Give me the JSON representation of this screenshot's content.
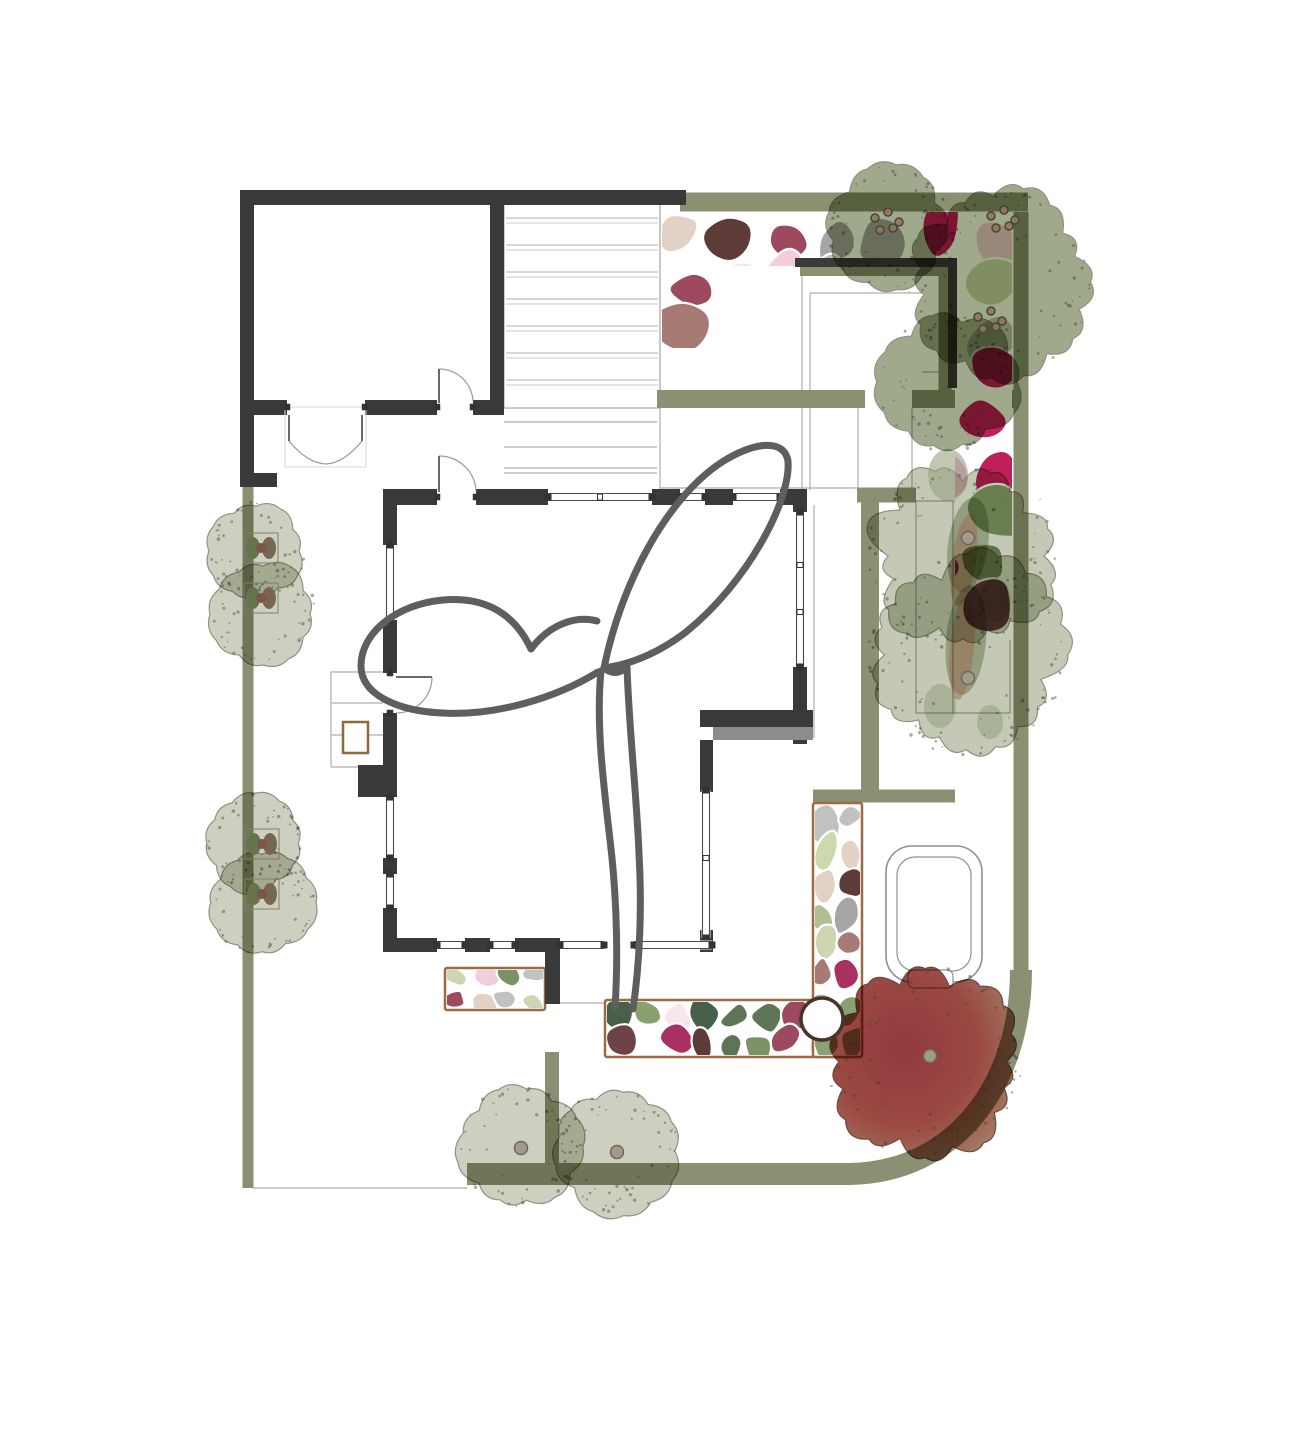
{
  "palette": {
    "wall": "#3a3a3a",
    "wall_shadow": "#8c8c8c",
    "hedge": "#8a9072",
    "line": "#adadad",
    "line_light": "#c9c9c9",
    "canopy_outline": "#5e5e5e",
    "bed_border": "#9c6b44",
    "tree_pale": "#c8cbb9",
    "tree_olive": "#97a081",
    "tree_mid": "#bdc3ad",
    "tree_stroke": "#8f9383",
    "speckle": "#3e4434",
    "berry_fill": "#8a7a57",
    "berry_stroke": "#4a4433",
    "shrub_green": "#66744b",
    "shrub_brown": "#77674e",
    "shrub_dot": "#7b544a",
    "ring_stroke": "#46332a",
    "tub_stroke": "#909090",
    "bench_stroke": "#8a6b3f",
    "red_tree_stops": [
      "#8c3136",
      "#97423c",
      "#9c6e57",
      "#a2a48a"
    ],
    "pebbles": [
      "#e9a3c0",
      "#f2cedd",
      "#f7e7ea",
      "#e2d2c6",
      "#bf2059",
      "#a93061",
      "#9d4a5e",
      "#a87a74",
      "#8a5f58",
      "#6e4347",
      "#5d3b39",
      "#8ba06f",
      "#5f7454",
      "#47604b",
      "#aebf92",
      "#ccd8ae",
      "#7d9166",
      "#a6a6a6",
      "#bfc2be",
      "#cdd6b0"
    ]
  },
  "plan": {
    "canvas": {
      "w": 1291,
      "h": 1429
    },
    "paving": {
      "deck_rect": [
        504,
        197,
        156,
        211
      ],
      "plank_ys": [
        218,
        245,
        272,
        299,
        326,
        353,
        380
      ],
      "plank_x": [
        506,
        658
      ],
      "lines": [
        [
          504,
          422,
          657,
          422
        ],
        [
          504,
          447,
          657,
          447
        ],
        [
          504,
          468,
          657,
          468
        ],
        [
          504,
          473,
          657,
          473
        ],
        [
          660,
          197,
          660,
          490
        ],
        [
          802,
          266,
          802,
          490
        ],
        [
          810,
          293,
          810,
          490
        ],
        [
          858,
          408,
          858,
          488
        ],
        [
          912,
          408,
          912,
          488
        ],
        [
          832,
          268,
          945,
          268
        ],
        [
          810,
          293,
          922,
          293
        ],
        [
          922,
          372,
          945,
          372
        ],
        [
          660,
          488,
          858,
          488
        ],
        [
          814,
          505,
          814,
          738
        ],
        [
          331,
          672,
          331,
          767
        ],
        [
          331,
          672,
          383,
          672
        ],
        [
          331,
          703,
          383,
          703
        ],
        [
          331,
          735,
          383,
          735
        ],
        [
          331,
          767,
          383,
          767
        ],
        [
          253,
          1188,
          467,
          1188
        ],
        [
          540,
          1003,
          605,
          1003
        ]
      ],
      "structure_rect": [
        916,
        501,
        94,
        212
      ],
      "structure_line": [
        953,
        501,
        953,
        713
      ]
    },
    "hedges": [
      {
        "x1": 680,
        "y1": 202,
        "x2": 1028,
        "y2": 202,
        "w": 19
      },
      {
        "x1": 1021,
        "y1": 212,
        "x2": 1021,
        "y2": 975,
        "w": 15
      },
      {
        "d": "M 1021,970 C 1021,1085 955,1172 850,1174 L 467,1174",
        "w": 22
      },
      {
        "x1": 248,
        "y1": 487,
        "x2": 248,
        "y2": 1188,
        "w": 11
      },
      {
        "x1": 657,
        "y1": 399,
        "x2": 865,
        "y2": 399,
        "w": 18
      },
      {
        "x1": 912,
        "y1": 399,
        "x2": 1021,
        "y2": 399,
        "w": 18
      },
      {
        "x1": 857,
        "y1": 495,
        "x2": 916,
        "y2": 495,
        "w": 15
      },
      {
        "x1": 552,
        "y1": 1052,
        "x2": 552,
        "y2": 1174,
        "w": 14
      },
      {
        "x1": 813,
        "y1": 796,
        "x2": 955,
        "y2": 796,
        "w": 13
      },
      {
        "x1": 870,
        "y1": 500,
        "x2": 870,
        "y2": 798,
        "w": 18
      },
      {
        "x1": 800,
        "y1": 271,
        "x2": 950,
        "y2": 271,
        "w": 10
      },
      {
        "x1": 945,
        "y1": 266,
        "x2": 945,
        "y2": 392,
        "w": 13
      }
    ],
    "walls": [
      [
        240,
        190,
        446,
        15
      ],
      [
        240,
        190,
        14,
        297
      ],
      [
        490,
        190,
        14,
        225
      ],
      [
        254,
        400,
        33,
        15
      ],
      [
        365,
        400,
        72,
        15
      ],
      [
        473,
        400,
        31,
        15
      ],
      [
        243,
        473,
        34,
        14
      ],
      [
        795,
        258,
        162,
        9
      ],
      [
        948,
        258,
        9,
        130
      ],
      [
        388,
        489,
        49,
        16
      ],
      [
        476,
        489,
        72,
        16
      ],
      [
        652,
        489,
        28,
        16
      ],
      [
        705,
        489,
        28,
        16
      ],
      [
        780,
        489,
        27,
        16
      ],
      [
        793,
        489,
        14,
        23
      ],
      [
        793,
        667,
        14,
        77
      ],
      [
        700,
        710,
        113,
        17
      ],
      [
        700,
        740,
        13,
        52
      ],
      [
        700,
        930,
        13,
        22
      ],
      [
        388,
        938,
        49,
        14
      ],
      [
        465,
        938,
        25,
        14
      ],
      [
        515,
        938,
        45,
        14
      ],
      [
        545,
        938,
        15,
        66
      ],
      [
        383,
        489,
        14,
        56
      ],
      [
        383,
        620,
        14,
        53
      ],
      [
        383,
        713,
        14,
        54
      ],
      [
        358,
        765,
        39,
        32
      ],
      [
        383,
        858,
        14,
        16
      ],
      [
        383,
        908,
        14,
        44
      ]
    ],
    "wall_shadow_rect": [
      713,
      727,
      100,
      13
    ],
    "windows": [
      {
        "o": "h",
        "c": 497,
        "a": 548,
        "b": 652,
        "m": [
          600
        ]
      },
      {
        "o": "h",
        "c": 497,
        "a": 680,
        "b": 705,
        "m": []
      },
      {
        "o": "h",
        "c": 497,
        "a": 733,
        "b": 780,
        "m": []
      },
      {
        "o": "v",
        "c": 390,
        "a": 545,
        "b": 620,
        "m": []
      },
      {
        "o": "v",
        "c": 390,
        "a": 797,
        "b": 858,
        "m": []
      },
      {
        "o": "v",
        "c": 390,
        "a": 874,
        "b": 908,
        "m": []
      },
      {
        "o": "v",
        "c": 800,
        "a": 512,
        "b": 667,
        "m": [
          565,
          612
        ]
      },
      {
        "o": "v",
        "c": 706,
        "a": 790,
        "b": 938,
        "m": [
          858
        ]
      },
      {
        "o": "h",
        "c": 945,
        "a": 437,
        "b": 465,
        "m": []
      },
      {
        "o": "h",
        "c": 945,
        "a": 490,
        "b": 515,
        "m": []
      },
      {
        "o": "h",
        "c": 945,
        "a": 560,
        "b": 604,
        "m": []
      },
      {
        "o": "h",
        "c": 945,
        "a": 634,
        "b": 712,
        "m": []
      }
    ],
    "doors": [
      {
        "leaf": [
          289,
          415,
          289,
          441
        ],
        "arc": "M 289,441 Q 307,463 326,464",
        "posts": [
          [
            287,
            407
          ],
          [
            365,
            407
          ]
        ],
        "box": [
          285,
          407,
          81,
          60
        ]
      },
      {
        "leaf": [
          362,
          415,
          362,
          441
        ],
        "arc": "M 362,441 Q 344,463 326,464",
        "posts": []
      },
      {
        "leaf": [
          439,
          403,
          439,
          369
        ],
        "arc": "M 439,369 A 34 34 0 0 1 473,401",
        "posts": [
          [
            437,
            407
          ],
          [
            473,
            407
          ]
        ]
      },
      {
        "leaf": [
          439,
          492,
          439,
          456
        ],
        "arc": "M 439,456 A 37 37 0 0 1 476,491",
        "posts": [
          [
            437,
            497
          ],
          [
            476,
            497
          ]
        ]
      },
      {
        "leaf": [
          396,
          677,
          432,
          677
        ],
        "arc": "M 432,677 A 36 36 0 0 1 396,713",
        "posts": [
          [
            390,
            673
          ],
          [
            390,
            713
          ]
        ]
      }
    ],
    "canopy_paths": [
      "M 604,668 C 620,588 664,500 722,462 C 754,442 784,438 788,461 C 791,500 748,582 686,632 C 660,652 632,664 604,668 Z",
      "M 598,672 C 556,698 496,716 442,713 C 398,711 362,695 361,667 C 360,633 397,604 443,600 C 489,596 516,617 531,649 C 549,625 575,615 597,621",
      "M 601,671 C 595,731 606,801 612,858 C 617,908 618,962 615,1007",
      "M 604,668 C 614,676 621,672 627,667 C 629,729 637,799 639,854 C 642,906 640,962 633,1009"
    ],
    "beds": {
      "top": {
        "poly": [
          [
            662,
            212
          ],
          [
            1012,
            212
          ],
          [
            1012,
            640
          ],
          [
            955,
            640
          ],
          [
            955,
            266
          ],
          [
            717,
            266
          ],
          [
            717,
            348
          ],
          [
            662,
            348
          ]
        ],
        "bbox": [
          662,
          212,
          350,
          428
        ],
        "cell": 50,
        "seed": 21
      },
      "bordered": [
        {
          "rect": [
            445,
            968,
            100,
            42
          ],
          "cell": 27,
          "seed": 22
        },
        {
          "rect": [
            605,
            1000,
            257,
            57
          ],
          "cell": 30,
          "seed": 23
        },
        {
          "rect": [
            813,
            803,
            49,
            254
          ],
          "cell": 30,
          "seed": 24
        }
      ]
    },
    "fixtures": {
      "bench_rect": [
        343,
        722,
        25,
        31
      ],
      "hot_tub_outer": [
        886,
        846,
        96,
        136,
        26
      ],
      "hot_tub_inner": [
        897,
        857,
        74,
        114,
        18
      ],
      "hot_tub_tab": [
        908,
        970,
        45,
        18,
        6
      ],
      "tree_ring": {
        "cx": 822,
        "cy": 1019,
        "r": 21
      }
    },
    "trees": [
      {
        "t": "pale",
        "cx": 256,
        "cy": 551,
        "r": 50,
        "s": 1
      },
      {
        "t": "pale",
        "cx": 263,
        "cy": 614,
        "r": 54,
        "s": 2
      },
      {
        "t": "pale",
        "cx": 255,
        "cy": 843,
        "r": 50,
        "s": 3
      },
      {
        "t": "pale",
        "cx": 262,
        "cy": 903,
        "r": 54,
        "s": 4
      },
      {
        "t": "pale",
        "cx": 520,
        "cy": 1147,
        "r": 63,
        "s": 5,
        "dotxy": [
          521,
          1148
        ]
      },
      {
        "t": "pale",
        "cx": 616,
        "cy": 1151,
        "r": 64,
        "s": 6,
        "dotxy": [
          617,
          1152
        ]
      },
      {
        "t": "olive",
        "cx": 889,
        "cy": 227,
        "r": 64,
        "s": 7
      },
      {
        "t": "olive",
        "cx": 1000,
        "cy": 282,
        "r": 95,
        "s": 8
      },
      {
        "t": "olive",
        "cx": 948,
        "cy": 382,
        "r": 72,
        "s": 9
      },
      {
        "t": "mid",
        "cx": 963,
        "cy": 556,
        "r": 98,
        "s": 10,
        "dotxy": [
          968,
          538
        ],
        "blobs": [
          [
            968,
            545,
            20,
            48,
            8,
            "#8e9778",
            0.85
          ],
          [
            964,
            560,
            12,
            46,
            8,
            "#9a6a4e",
            0.5
          ],
          [
            948,
            475,
            20,
            26,
            0,
            "#98a182",
            0.6
          ],
          [
            995,
            600,
            16,
            22,
            0,
            "#98a182",
            0.6
          ]
        ]
      },
      {
        "t": "mid",
        "cx": 966,
        "cy": 655,
        "r": 102,
        "s": 11,
        "dotxy": [
          968,
          678
        ],
        "blobs": [
          [
            966,
            640,
            20,
            55,
            5,
            "#8e9778",
            0.85
          ],
          [
            962,
            648,
            12,
            52,
            5,
            "#9a6a4e",
            0.5
          ],
          [
            940,
            706,
            16,
            22,
            0,
            "#98a182",
            0.6
          ],
          [
            990,
            722,
            13,
            17,
            0,
            "#98a182",
            0.6
          ]
        ]
      },
      {
        "t": "red",
        "cx": 925,
        "cy": 1062,
        "r": 99,
        "s": 12,
        "dotxy": [
          930,
          1056
        ]
      }
    ],
    "berry_clusters": [
      {
        "x": 884,
        "y": 224
      },
      {
        "x": 1000,
        "y": 222
      },
      {
        "x": 987,
        "y": 323
      }
    ],
    "berry_offsets": [
      [
        -9,
        -6
      ],
      [
        4,
        -12
      ],
      [
        15,
        -2
      ],
      [
        -4,
        6
      ],
      [
        9,
        4
      ]
    ],
    "shrub_icons": [
      [
        261,
        548
      ],
      [
        261,
        598
      ],
      [
        262,
        844
      ],
      [
        262,
        894
      ]
    ]
  }
}
